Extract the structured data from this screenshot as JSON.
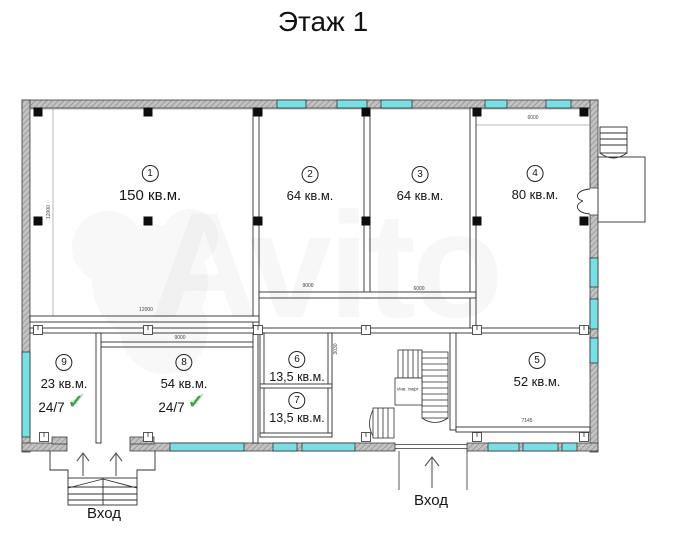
{
  "title": "Этаж 1",
  "watermark": "Avito",
  "icons": {
    "check": "✓"
  },
  "rooms": [
    {
      "num": "1",
      "area": "150 кв.м."
    },
    {
      "num": "2",
      "area": "64 кв.м."
    },
    {
      "num": "3",
      "area": "64 кв.м."
    },
    {
      "num": "4",
      "area": "80 кв.м."
    },
    {
      "num": "5",
      "area": "52 кв.м."
    },
    {
      "num": "6",
      "area": "13,5 кв.м."
    },
    {
      "num": "7",
      "area": "13,5 кв.м."
    },
    {
      "num": "8",
      "area": "54 кв.м.",
      "badge": "24/7"
    },
    {
      "num": "9",
      "area": "23 кв.м.",
      "badge": "24/7"
    }
  ],
  "entrances": [
    {
      "label": "Вход"
    },
    {
      "label": "Вход"
    }
  ],
  "stair": {
    "lift_label": "Инв. лифт"
  },
  "dimensions": [
    "12000",
    "9000",
    "6000",
    "9000",
    "6000",
    "7145",
    "12000",
    "3030"
  ],
  "colors": {
    "window": "#79dfe5",
    "wall_fill": "#c2c2c2",
    "column": "#0d0d0d",
    "check_green": "#44a04f"
  }
}
